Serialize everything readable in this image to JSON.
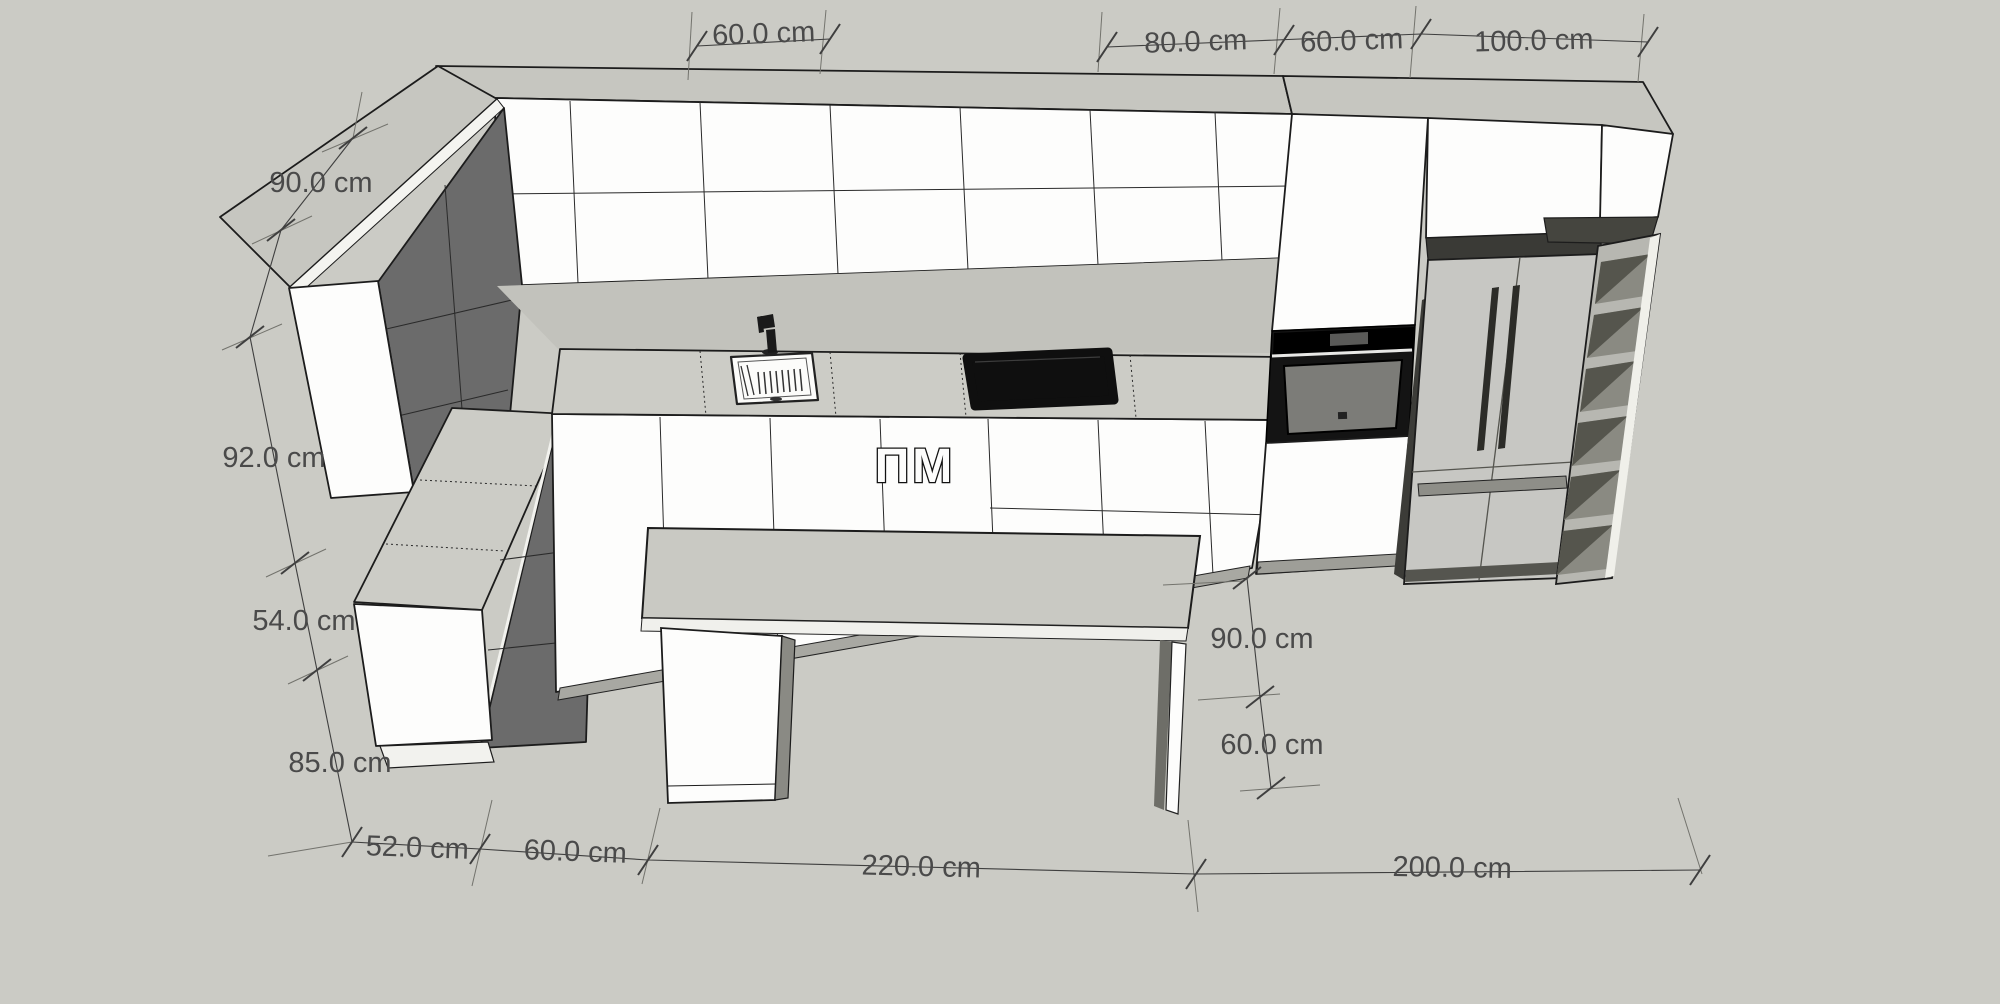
{
  "scene": {
    "type": "3d-kitchen-model",
    "units": "cm",
    "appliance_label": "ПМ"
  },
  "dimensions": {
    "top": [
      "60.0 cm",
      "80.0 cm",
      "60.0 cm",
      "100.0 cm"
    ],
    "left": [
      "90.0 cm",
      "92.0 cm",
      "54.0 cm",
      "85.0 cm"
    ],
    "bottom": [
      "52.0 cm",
      "60.0 cm",
      "220.0 cm",
      "200.0 cm"
    ],
    "right": [
      "90.0 cm",
      "60.0 cm"
    ]
  },
  "colors": {
    "background": "#cbcbc5",
    "cabinet_front": "#fdfdfc",
    "cabinet_top": "#c6c6c0",
    "counter": "#ccccc6",
    "shadow_side": "#6b6b6b",
    "appliance_black": "#141414",
    "fridge_body": "#c7c7c3",
    "dimension_text": "#4a4a4a"
  }
}
